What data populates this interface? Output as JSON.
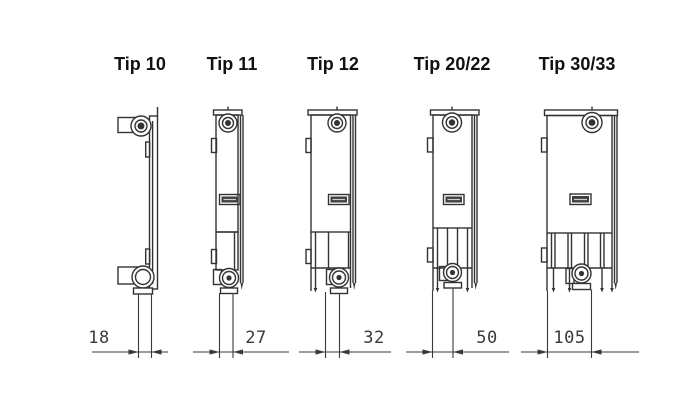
{
  "diagram": {
    "types": [
      {
        "label": "Tip 10",
        "depth": "18"
      },
      {
        "label": "Tip 11",
        "depth": "27"
      },
      {
        "label": "Tip 12",
        "depth": "32"
      },
      {
        "label": "Tip 20/22",
        "depth": "50"
      },
      {
        "label": "Tip 30/33",
        "depth": "105"
      }
    ],
    "colors": {
      "line": "#333333",
      "dimension_line": "#3a3a3a",
      "label_text": "#111111",
      "dimension_text": "#3a3a3a",
      "background": "#ffffff"
    }
  }
}
